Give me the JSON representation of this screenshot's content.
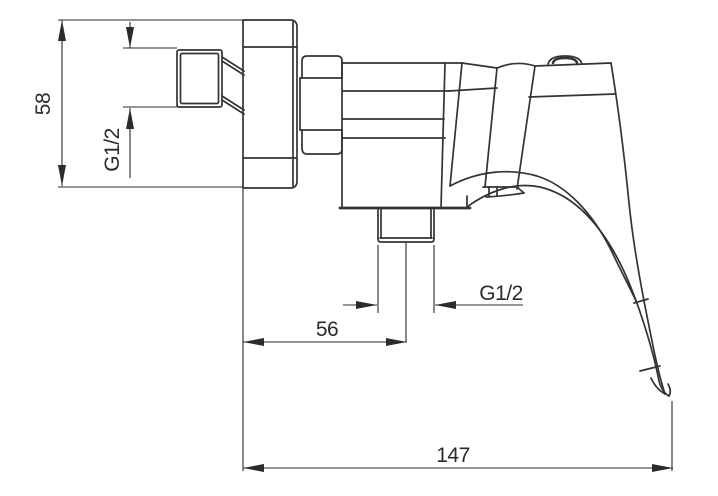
{
  "drawing": {
    "subject": "wall-mounted single-lever shower mixer, side elevation technical drawing",
    "background": "#ffffff",
    "line_color": "#333333",
    "dim_color": "#2b2b2b",
    "dims": {
      "height": "58",
      "inlet_thread": "G1/2",
      "outlet_thread": "G1/2",
      "outlet_offset": "56",
      "overall_length": "147"
    }
  }
}
